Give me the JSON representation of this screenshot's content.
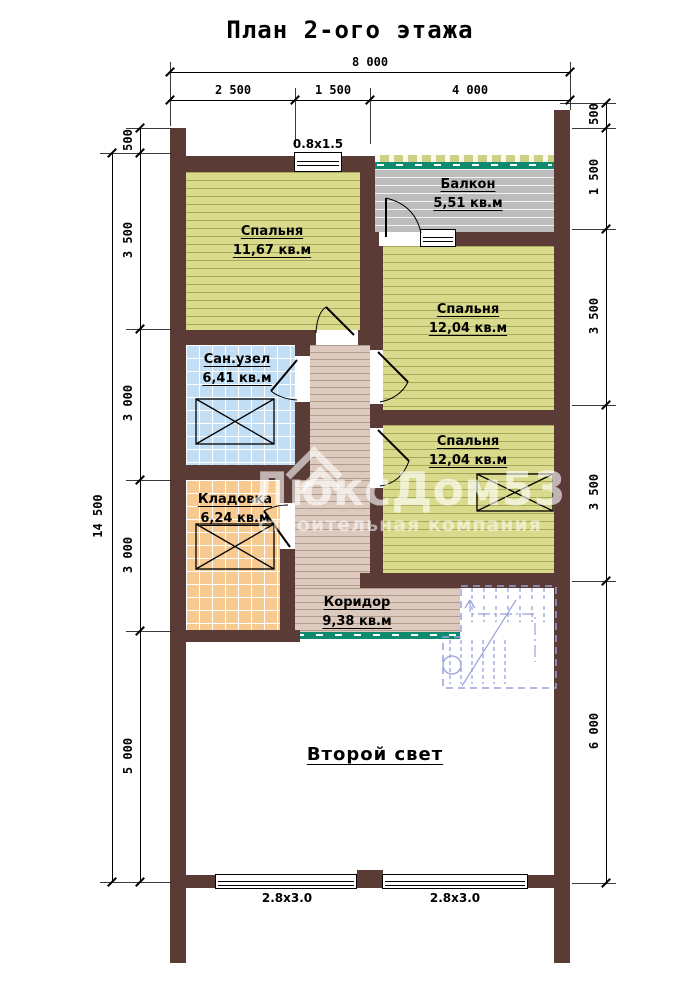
{
  "title": "План 2-ого этажа",
  "watermark": {
    "brand": "ЛюксДом53",
    "subtitle": "строительная компания"
  },
  "dimensions": {
    "top": {
      "total": "8 000",
      "segments": [
        "2 500",
        "1 500",
        "4 000"
      ]
    },
    "left": {
      "total": "14 500",
      "segments": [
        "500",
        "3 500",
        "3 000",
        "3 000",
        "5 000"
      ]
    },
    "right": {
      "segments": [
        "500",
        "1 500",
        "3 500",
        "3 500",
        "6 000"
      ]
    }
  },
  "rooms": [
    {
      "name": "Спальня",
      "area": "11,67 кв.м"
    },
    {
      "name": "Балкон",
      "area": "5,51 кв.м"
    },
    {
      "name": "Спальня",
      "area": "12,04 кв.м"
    },
    {
      "name": "Сан.узел",
      "area": "6,41 кв.м"
    },
    {
      "name": "Спальня",
      "area": "12,04 кв.м"
    },
    {
      "name": "Кладовка",
      "area": "6,24 кв.м"
    },
    {
      "name": "Коридор",
      "area": "9,38 кв.м"
    },
    {
      "name": "Второй свет",
      "area": ""
    }
  ],
  "windows": {
    "top": "0.8х1.5",
    "bottom_left": "2.8х3.0",
    "bottom_right": "2.8х3.0"
  }
}
